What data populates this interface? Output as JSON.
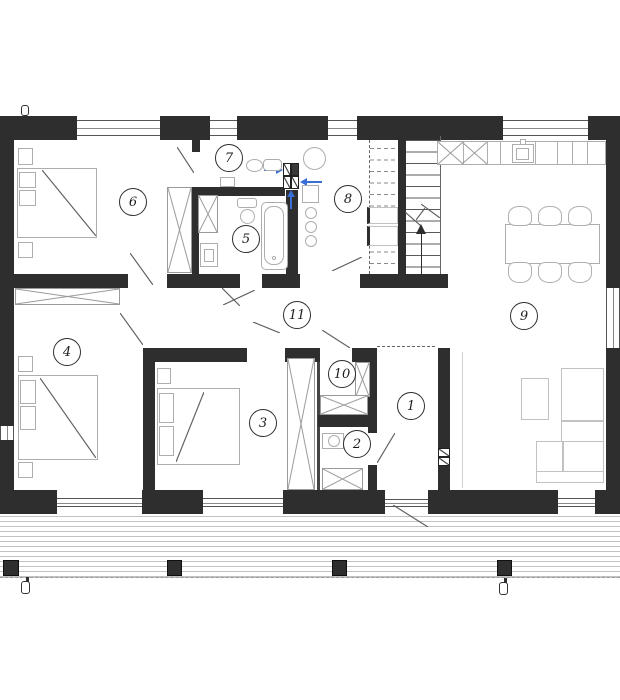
{
  "rooms": [
    {
      "number": "1"
    },
    {
      "number": "2"
    },
    {
      "number": "3"
    },
    {
      "number": "4"
    },
    {
      "number": "5"
    },
    {
      "number": "6"
    },
    {
      "number": "7"
    },
    {
      "number": "8"
    },
    {
      "number": "9"
    },
    {
      "number": "10"
    },
    {
      "number": "11"
    }
  ],
  "colors": {
    "wall": "#2e2e2e",
    "furniture_line": "#adadad",
    "annotation_line": "#555555",
    "vent_arrow_blue": "#3a6fd8",
    "deck_plank_line": "#c2c2c2"
  }
}
